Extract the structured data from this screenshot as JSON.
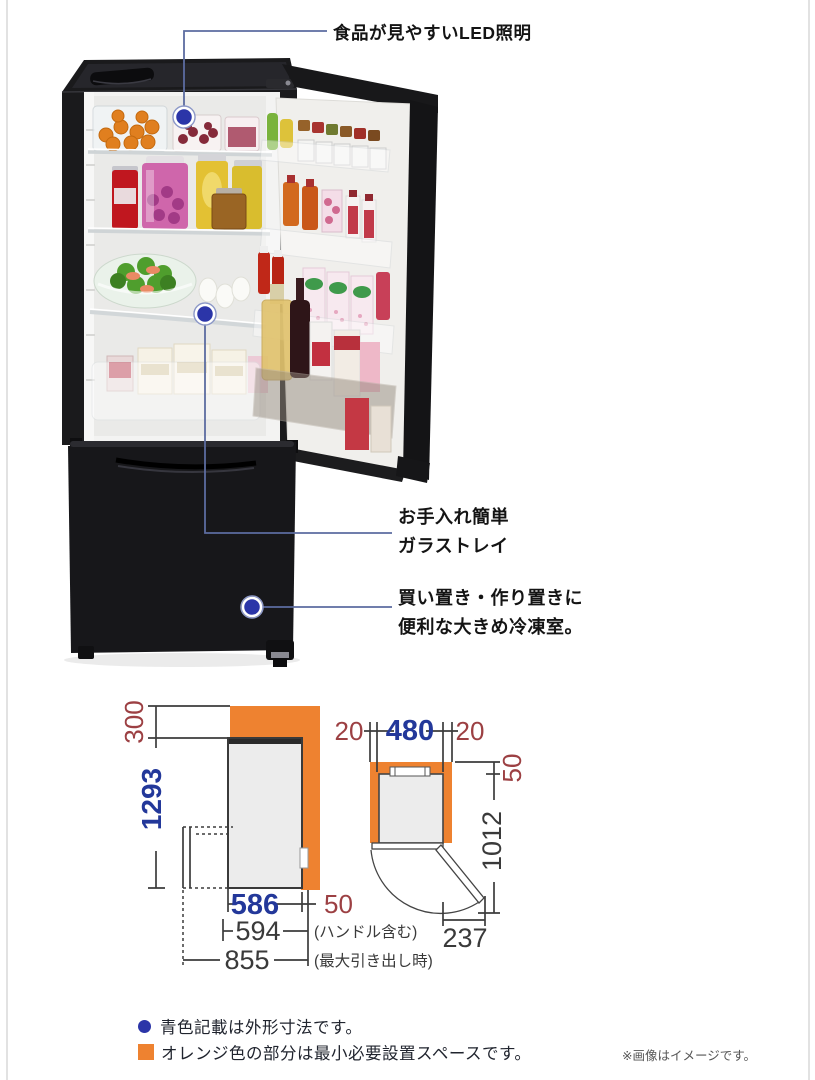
{
  "callouts": {
    "led": {
      "label": "食品が見やすいLED照明"
    },
    "tray": {
      "line1": "お手入れ簡単",
      "line2": "ガラストレイ"
    },
    "freezer": {
      "line1": "買い置き・作り置きに",
      "line2": "便利な大きめ冷凍室。"
    }
  },
  "diagram": {
    "side_view": {
      "top_clearance": "300",
      "body_height": "1293",
      "body_depth": "586",
      "rear_clearance": "50",
      "depth_with_handle": "594",
      "depth_with_handle_note": "(ハンドル含む)",
      "depth_drawer_open": "855",
      "depth_drawer_open_note": "(最大引き出し時)"
    },
    "top_view": {
      "left_clearance": "20",
      "body_width": "480",
      "right_clearance": "20",
      "rear_clearance": "50",
      "depth_door_open": "1012",
      "door_swing_width": "237"
    },
    "colors": {
      "clearance_orange": "#ee8230",
      "outer_dimension_blue": "#23389a",
      "clearance_red": "#9c4043"
    }
  },
  "legend": {
    "blue_note": "青色記載は外形寸法です。",
    "orange_note": "オレンジ色の部分は最小必要設置スペースです。"
  },
  "footnote": "※画像はイメージです。"
}
